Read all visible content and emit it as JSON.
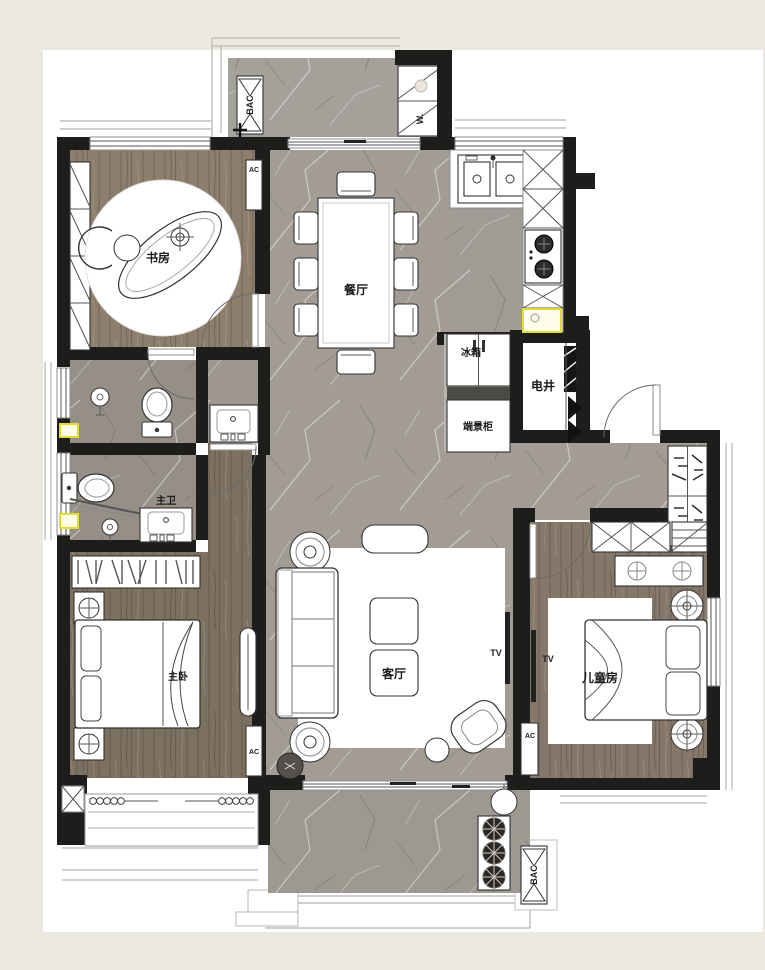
{
  "plan": {
    "rooms": {
      "study": "书房",
      "dining": "餐厅",
      "living": "客厅",
      "master_bedroom": "主卧",
      "kids_room": "儿童房",
      "master_bath": "主卫",
      "utility_shaft": "电井",
      "fridge": "冰箱",
      "end_cabinet": "端景柜"
    },
    "annotations": {
      "tv_living": "TV",
      "tv_kids": "TV",
      "ac_study": "AC",
      "ac_master": "AC",
      "ac_kids": "AC",
      "washer": "W.",
      "bac_top": "BAC",
      "bac_bottom": "BAC"
    },
    "palette": {
      "wall": "#1d1d1b",
      "wood": "#8a7b6b",
      "marble": "#a5a097",
      "accent_yellow": "#e3da35",
      "page_background": "#ebe8e0"
    }
  }
}
